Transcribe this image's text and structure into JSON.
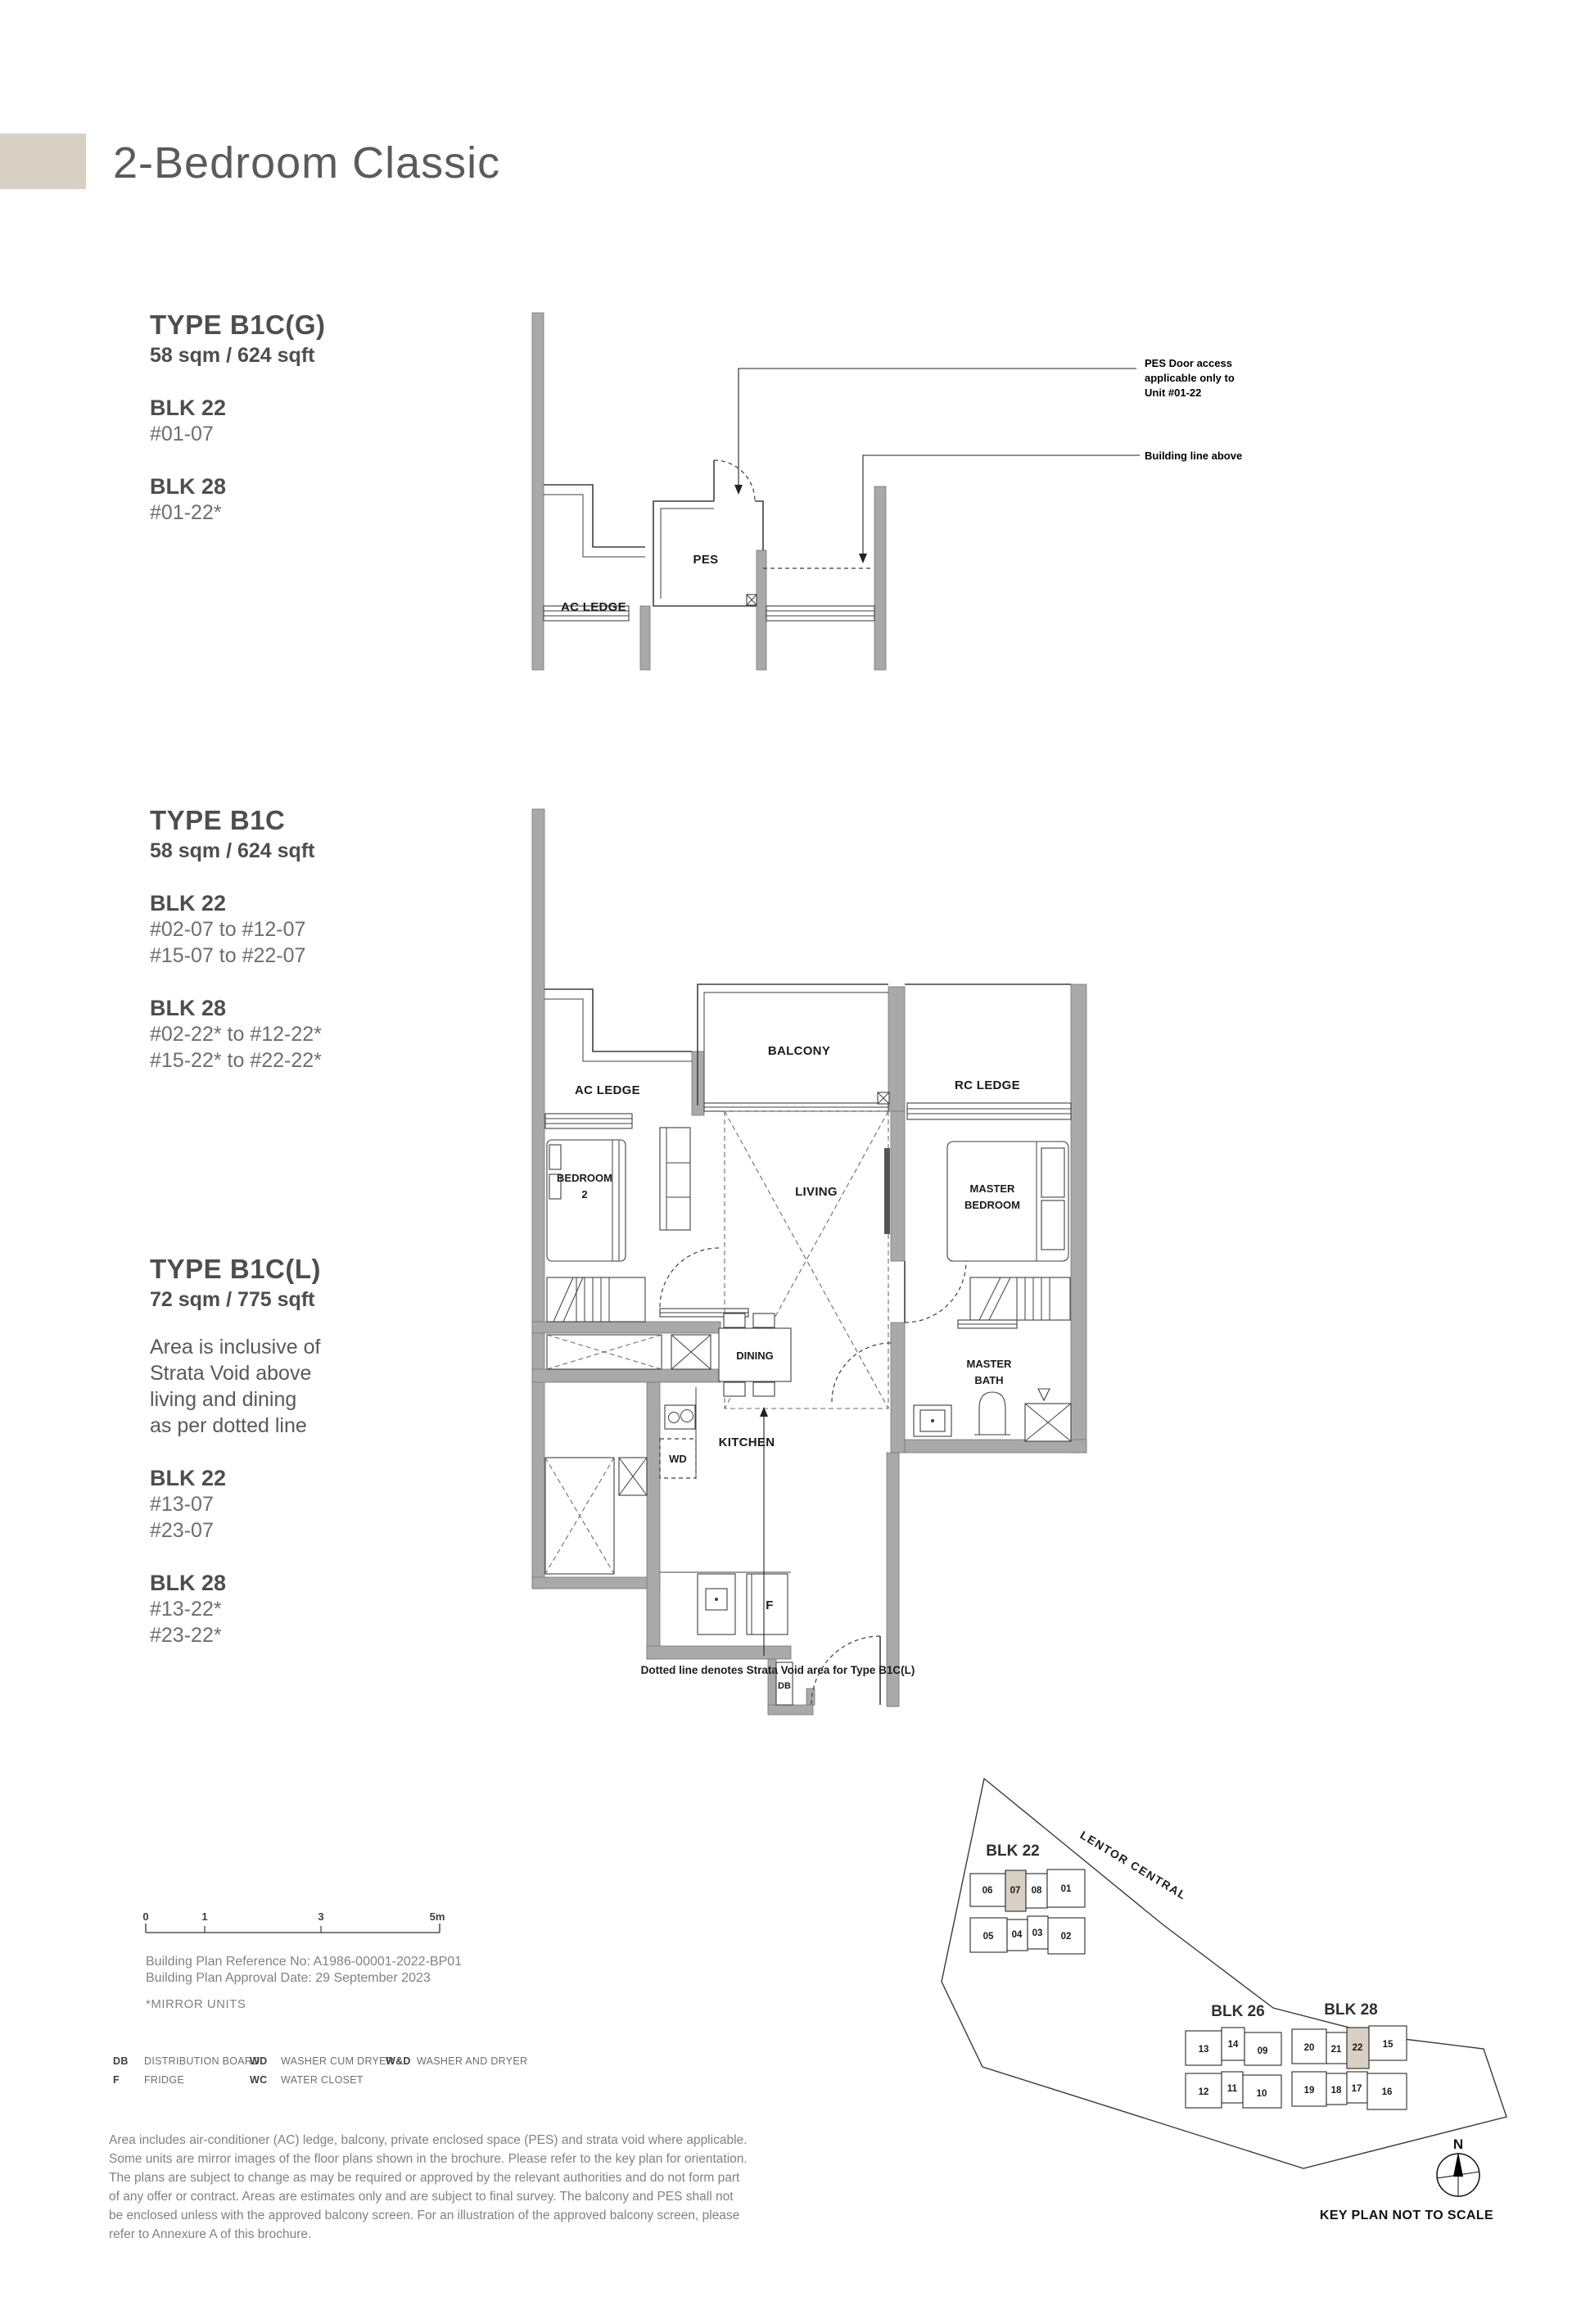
{
  "page": {
    "title": "2-Bedroom Classic"
  },
  "colors": {
    "accent": "#d8d0c3",
    "wall_gray": "#a9a9a9",
    "heading": "#4d4e50",
    "body_gray": "#6d6e71",
    "muted_gray": "#808285"
  },
  "types": {
    "b1cg": {
      "name": "TYPE B1C(G)",
      "area": "58 sqm / 624 sqft",
      "blocks": [
        {
          "blk": "BLK 22",
          "units": [
            "#01-07"
          ]
        },
        {
          "blk": "BLK 28",
          "units": [
            "#01-22*"
          ]
        }
      ]
    },
    "b1c": {
      "name": "TYPE B1C",
      "area": "58 sqm / 624 sqft",
      "blocks": [
        {
          "blk": "BLK 22",
          "units": [
            "#02-07 to #12-07",
            "#15-07 to #22-07"
          ]
        },
        {
          "blk": "BLK 28",
          "units": [
            "#02-22* to #12-22*",
            "#15-22* to #22-22*"
          ]
        }
      ]
    },
    "b1cl": {
      "name": "TYPE B1C(L)",
      "area": "72 sqm / 775 sqft",
      "note_lines": [
        "Area is inclusive of",
        "Strata Void above",
        "living and dining",
        "as per dotted line"
      ],
      "blocks": [
        {
          "blk": "BLK 22",
          "units": [
            "#13-07",
            "#23-07"
          ]
        },
        {
          "blk": "BLK 28",
          "units": [
            "#13-22*",
            "#23-22*"
          ]
        }
      ]
    }
  },
  "plan_top": {
    "labels": {
      "ac_ledge": "AC LEDGE",
      "pes": "PES"
    },
    "annotations": {
      "pes_door": [
        "PES Door access",
        "applicable only to",
        "Unit #01-22"
      ],
      "building_line": "Building line above"
    }
  },
  "plan_main": {
    "labels": {
      "ac_ledge": "AC LEDGE",
      "balcony": "BALCONY",
      "rc_ledge": "RC LEDGE",
      "bedroom2": [
        "BEDROOM",
        "2"
      ],
      "living": "LIVING",
      "master_bedroom": [
        "MASTER",
        "BEDROOM"
      ],
      "dining": "DINING",
      "kitchen": "KITCHEN",
      "wd": "WD",
      "f": "F",
      "db": "DB",
      "master_bath": [
        "MASTER",
        "BATH"
      ]
    },
    "caption": "Dotted line denotes Strata Void area for Type B1C(L)"
  },
  "scale_bar": {
    "ticks": [
      "0",
      "1",
      "3",
      "5m"
    ]
  },
  "building_plan": {
    "reference": "Building Plan Reference No: A1986-00001-2022-BP01",
    "approval": "Building Plan Approval Date: 29 September 2023",
    "mirror_note": "*MIRROR UNITS"
  },
  "legend": {
    "items": [
      {
        "abbr": "DB",
        "label": "DISTRIBUTION BOARD"
      },
      {
        "abbr": "F",
        "label": "FRIDGE"
      },
      {
        "abbr": "WD",
        "label": "WASHER CUM DRYER"
      },
      {
        "abbr": "WC",
        "label": "WATER CLOSET"
      },
      {
        "abbr": "W&D",
        "label": "WASHER AND DRYER"
      }
    ]
  },
  "disclaimer": "Area includes air-conditioner (AC) ledge, balcony, private enclosed space (PES) and strata void where applicable. Some units are mirror images of the floor plans shown in the brochure. Please refer to the key plan for orientation. The plans are subject to change as may be required or approved by the relevant authorities and do not form part of any offer or contract. Areas are estimates only and are subject to final survey. The balcony and PES shall not be enclosed unless with the approved balcony screen. For an illustration of the approved balcony screen, please refer to Annexure A of this brochure.",
  "key_plan": {
    "road": "LENTOR CENTRAL",
    "note": "KEY PLAN NOT TO SCALE",
    "north": "N",
    "blk22": {
      "label": "BLK 22",
      "top": [
        "06",
        "07",
        "08",
        "01"
      ],
      "bottom": [
        "05",
        "04",
        "03",
        "02"
      ]
    },
    "blk26": {
      "label": "BLK 26",
      "top": [
        "13",
        "14",
        "09"
      ],
      "bottom": [
        "12",
        "11",
        "10"
      ]
    },
    "blk28": {
      "label": "BLK 28",
      "top": [
        "20",
        "21",
        "22",
        "15"
      ],
      "bottom": [
        "19",
        "18",
        "17",
        "16"
      ]
    }
  }
}
